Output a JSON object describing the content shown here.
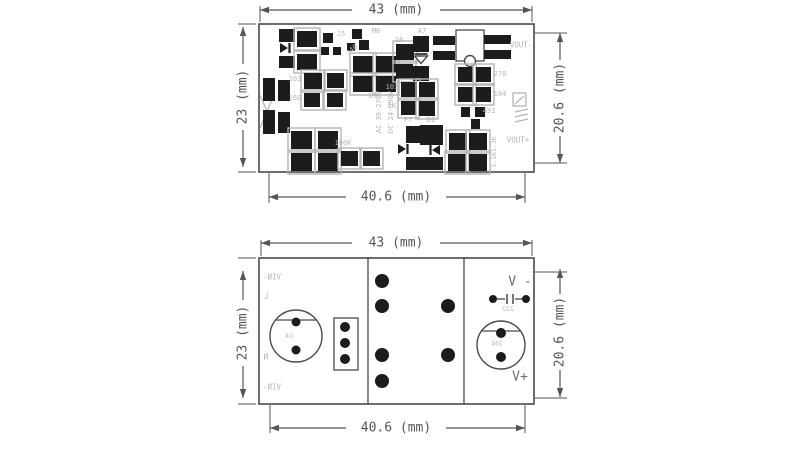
{
  "title": "pcb-power-module-dimension-drawing",
  "colors": {
    "background": "#ffffff",
    "outline": "#4a4a4a",
    "dim": "#555555",
    "pad": "#1c1c1c",
    "silk": "#b4b4b4",
    "text_dark": "#6e6e6e"
  },
  "views": [
    {
      "name": "pcb-top-view",
      "board": {
        "x": 259,
        "y": 24,
        "w": 275,
        "h": 148
      },
      "dividers": [],
      "rects": [
        [
          456,
          30,
          28,
          31,
          "outline",
          "transformer-outline"
        ],
        [
          513,
          93,
          13,
          13,
          "silk",
          "brand-logo-box"
        ]
      ],
      "circles": [
        {
          "cx": 470,
          "cy": 61,
          "r": 5.5,
          "fill": "#ffffff",
          "stroke": "outline",
          "n": "transformer-notch"
        }
      ],
      "lines": [
        [
          515,
          104,
          524,
          96,
          "silk",
          1.2,
          "brand-logo-stroke"
        ],
        [
          515,
          112,
          528,
          109,
          "silk",
          1.2,
          "brand-logo-stroke"
        ],
        [
          515,
          117,
          528,
          114,
          "silk",
          1.2,
          "brand-logo-stroke"
        ],
        [
          515,
          122,
          528,
          119,
          "silk",
          1.2,
          "brand-logo-stroke"
        ],
        [
          260,
          95,
          274,
          128,
          "silk",
          1.2,
          "component-ghost-outline"
        ],
        [
          274,
          95,
          260,
          128,
          "silk",
          1.2,
          "component-ghost-outline"
        ]
      ],
      "pads": [
        [
          279,
          29,
          16,
          13,
          0
        ],
        [
          279,
          56,
          16,
          12,
          0
        ],
        [
          297,
          31,
          20,
          16,
          1
        ],
        [
          297,
          54,
          20,
          16,
          1
        ],
        [
          323,
          33,
          10,
          10,
          0
        ],
        [
          352,
          29,
          10,
          10,
          0
        ],
        [
          321,
          47,
          8,
          8,
          0
        ],
        [
          333,
          47,
          8,
          8,
          0
        ],
        [
          347,
          43,
          8,
          8,
          0
        ],
        [
          359,
          40,
          10,
          10,
          0
        ],
        [
          353,
          56,
          20,
          17,
          1
        ],
        [
          376,
          56,
          20,
          17,
          1
        ],
        [
          353,
          76,
          20,
          16,
          1
        ],
        [
          376,
          76,
          20,
          16,
          1
        ],
        [
          304,
          73,
          18,
          16,
          1
        ],
        [
          327,
          73,
          17,
          15,
          1
        ],
        [
          304,
          93,
          16,
          14,
          1
        ],
        [
          327,
          93,
          16,
          14,
          1
        ],
        [
          263,
          78,
          12,
          23,
          0
        ],
        [
          278,
          80,
          12,
          21,
          0
        ],
        [
          263,
          110,
          12,
          24,
          0
        ],
        [
          278,
          112,
          12,
          21,
          0
        ],
        [
          291,
          131,
          21,
          18,
          1
        ],
        [
          318,
          131,
          20,
          18,
          1
        ],
        [
          291,
          153,
          21,
          18,
          1
        ],
        [
          318,
          153,
          20,
          18,
          1
        ],
        [
          341,
          151,
          17,
          15,
          1
        ],
        [
          363,
          151,
          17,
          15,
          1
        ],
        [
          396,
          44,
          18,
          16,
          1
        ],
        [
          396,
          64,
          17,
          15,
          1
        ],
        [
          413,
          36,
          16,
          16,
          0
        ],
        [
          413,
          66,
          16,
          15,
          0
        ],
        [
          401,
          82,
          16,
          15,
          1
        ],
        [
          419,
          82,
          16,
          15,
          1
        ],
        [
          401,
          101,
          15,
          14,
          1
        ],
        [
          419,
          101,
          16,
          15,
          1
        ],
        [
          406,
          126,
          18,
          17,
          0
        ],
        [
          406,
          157,
          18,
          13,
          0
        ],
        [
          420,
          125,
          23,
          20,
          0
        ],
        [
          420,
          157,
          23,
          13,
          0
        ],
        [
          433,
          36,
          22,
          9,
          0
        ],
        [
          433,
          51,
          22,
          9,
          0
        ],
        [
          484,
          35,
          27,
          9,
          0
        ],
        [
          484,
          50,
          27,
          9,
          0
        ],
        [
          458,
          67,
          15,
          15,
          1
        ],
        [
          476,
          67,
          15,
          15,
          1
        ],
        [
          458,
          87,
          15,
          15,
          1
        ],
        [
          476,
          87,
          15,
          15,
          1
        ],
        [
          461,
          107,
          9,
          10,
          0
        ],
        [
          475,
          107,
          10,
          10,
          0
        ],
        [
          471,
          119,
          9,
          10,
          0
        ],
        [
          449,
          133,
          18,
          17,
          1
        ],
        [
          469,
          133,
          18,
          17,
          1
        ],
        [
          448,
          154,
          18,
          17,
          1
        ],
        [
          469,
          154,
          18,
          17,
          1
        ]
      ],
      "holes": [],
      "symbols": [
        {
          "type": "diode-right",
          "x": 280,
          "y": 48,
          "n": "diode-symbol"
        },
        {
          "type": "diode-down-outline",
          "x": 421,
          "y": 56,
          "n": "diode-symbol-a7"
        },
        {
          "type": "diode-right",
          "x": 398,
          "y": 149,
          "n": "diode-symbol-f7"
        },
        {
          "type": "diode-left",
          "x": 440,
          "y": 150,
          "n": "diode-symbol-d2"
        }
      ],
      "dimensions": [
        {
          "n": "dim-top-width",
          "label": "43 (mm)",
          "orient": "h",
          "x1": 260,
          "x2": 532,
          "pos": 10,
          "label_at": 396,
          "gap": 44,
          "ext": [
            [
              260,
              6,
              260,
              22
            ],
            [
              532,
              6,
              532,
              22
            ]
          ]
        },
        {
          "n": "dim-left-height",
          "label": "23 (mm)",
          "orient": "v",
          "y1": 27,
          "y2": 167,
          "pos": 243,
          "label_at": 97,
          "gap": 33,
          "ext": [
            [
              238,
              24,
              256,
              24
            ],
            [
              238,
              172,
              256,
              172
            ]
          ]
        },
        {
          "n": "dim-right-height",
          "label": "20.6 (mm)",
          "orient": "v",
          "y1": 33,
          "y2": 163,
          "pos": 560,
          "label_at": 98,
          "gap": 38,
          "ext": [
            [
              535,
              33,
              567,
              33
            ],
            [
              535,
              163,
              567,
              163
            ]
          ]
        },
        {
          "n": "dim-bottom-width",
          "label": "40.6 (mm)",
          "orient": "h",
          "x1": 269,
          "x2": 525,
          "pos": 197,
          "label_at": 396,
          "gap": 50,
          "ext": [
            [
              269,
              173,
              269,
              203
            ],
            [
              525,
              173,
              525,
              203
            ]
          ]
        }
      ],
      "texts": [
        {
          "t": "J5",
          "x": 341,
          "y": 34,
          "n": "label-j5"
        },
        {
          "t": "M0",
          "x": 376,
          "y": 31,
          "n": "label-m0"
        },
        {
          "t": "340",
          "x": 352,
          "y": 50,
          "rot": -40,
          "n": "label-340"
        },
        {
          "t": "16",
          "x": 399,
          "y": 40,
          "n": "label-16"
        },
        {
          "t": "A7",
          "x": 422,
          "y": 31,
          "n": "label-a7"
        },
        {
          "t": "103",
          "x": 295,
          "y": 79,
          "n": "label-103-left"
        },
        {
          "t": "160",
          "x": 295,
          "y": 98,
          "n": "label-160"
        },
        {
          "t": "1M",
          "x": 372,
          "y": 96,
          "n": "label-1m"
        },
        {
          "t": "103",
          "x": 392,
          "y": 87,
          "n": "label-103-mid"
        },
        {
          "t": "1K",
          "x": 392,
          "y": 106,
          "n": "label-1k"
        },
        {
          "t": "F7",
          "x": 408,
          "y": 120,
          "n": "label-f7"
        },
        {
          "t": "D2",
          "x": 431,
          "y": 120,
          "n": "label-d2"
        },
        {
          "t": "100K",
          "x": 343,
          "y": 143,
          "n": "label-100k"
        },
        {
          "t": "AC 30-270V",
          "x": 379,
          "y": 112,
          "rot": -90,
          "n": "label-ac-range"
        },
        {
          "t": "DC 24-390V",
          "x": 391,
          "y": 112,
          "rot": -90,
          "n": "label-dc-range"
        },
        {
          "t": "VOUT-",
          "x": 521,
          "y": 45,
          "s": 7.5,
          "n": "label-vout-neg"
        },
        {
          "t": "270",
          "x": 500,
          "y": 74,
          "n": "label-270"
        },
        {
          "t": "104",
          "x": 500,
          "y": 94,
          "n": "label-104"
        },
        {
          "t": "431",
          "x": 489,
          "y": 111,
          "n": "label-431"
        },
        {
          "t": "5.1K1.3K",
          "x": 494,
          "y": 152,
          "rot": -90,
          "s": 6.5,
          "n": "label-5k1-1k3"
        },
        {
          "t": "VOUT+",
          "x": 518,
          "y": 140,
          "s": 7.5,
          "n": "label-vout-pos"
        }
      ]
    },
    {
      "name": "pcb-bottom-view",
      "board": {
        "x": 259,
        "y": 258,
        "w": 275,
        "h": 146
      },
      "dividers": [
        368,
        464
      ],
      "rects": [
        [
          334,
          318,
          24,
          52,
          "outline",
          "pin-connector-outline"
        ]
      ],
      "circles": [
        {
          "cx": 296,
          "cy": 336,
          "r": 26,
          "chord": 320,
          "stroke": "outline",
          "n": "electrolytic-cap-left"
        },
        {
          "cx": 501,
          "cy": 345,
          "r": 24,
          "chord": 331,
          "stroke": "outline",
          "n": "electrolytic-cap-right"
        }
      ],
      "lines": [
        [
          497,
          299,
          505,
          299,
          "dim",
          1.4,
          "cap-symbol-lead"
        ],
        [
          515,
          299,
          523,
          299,
          "dim",
          1.4,
          "cap-symbol-lead"
        ],
        [
          507,
          294,
          507,
          304,
          "dim",
          1.6,
          "cap-symbol-plate"
        ],
        [
          513,
          294,
          513,
          304,
          "dim",
          1.6,
          "cap-symbol-plate"
        ]
      ],
      "pads": [],
      "holes": [
        [
          296,
          322,
          4.5
        ],
        [
          296,
          350,
          4.5
        ],
        [
          345,
          327,
          5
        ],
        [
          345,
          343,
          5
        ],
        [
          345,
          359,
          5
        ],
        [
          382,
          281,
          7
        ],
        [
          382,
          306,
          7
        ],
        [
          382,
          355,
          7
        ],
        [
          382,
          381,
          7
        ],
        [
          448,
          306,
          7
        ],
        [
          448,
          355,
          7
        ],
        [
          493,
          299,
          4
        ],
        [
          526,
          299,
          4
        ],
        [
          501,
          333,
          5
        ],
        [
          501,
          357,
          5
        ]
      ],
      "symbols": [],
      "dimensions": [
        {
          "n": "dim-top-width",
          "label": "43 (mm)",
          "orient": "h",
          "x1": 261,
          "x2": 532,
          "pos": 243,
          "label_at": 396,
          "gap": 44,
          "ext": [
            [
              261,
              240,
              261,
              256
            ],
            [
              532,
              240,
              532,
              256
            ]
          ]
        },
        {
          "n": "dim-left-height",
          "label": "23 (mm)",
          "orient": "v",
          "y1": 271,
          "y2": 398,
          "pos": 243,
          "label_at": 333,
          "gap": 33,
          "ext": [
            [
              238,
              258,
              256,
              258
            ],
            [
              238,
              404,
              256,
              404
            ]
          ]
        },
        {
          "n": "dim-right-height",
          "label": "20.6 (mm)",
          "orient": "v",
          "y1": 269,
          "y2": 397,
          "pos": 560,
          "label_at": 332,
          "gap": 38,
          "ext": [
            [
              535,
              272,
              567,
              272
            ],
            [
              535,
              398,
              567,
              398
            ]
          ]
        },
        {
          "n": "dim-bottom-width",
          "label": "40.6 (mm)",
          "orient": "h",
          "x1": 270,
          "x2": 525,
          "pos": 428,
          "label_at": 396,
          "gap": 50,
          "ext": [
            [
              270,
              405,
              270,
              433
            ],
            [
              525,
              405,
              525,
              433
            ]
          ]
        }
      ],
      "texts": [
        {
          "t": "VIN-",
          "x": 272,
          "y": 277,
          "s": 7.5,
          "mir": 1,
          "n": "label-vin-neg-top"
        },
        {
          "t": "L",
          "x": 266,
          "y": 296,
          "s": 8,
          "mir": 1,
          "n": "label-line-l"
        },
        {
          "t": "C4",
          "x": 289,
          "y": 336,
          "s": 6.5,
          "mir": 1,
          "n": "label-c4"
        },
        {
          "t": "N",
          "x": 266,
          "y": 357,
          "s": 8,
          "mir": 1,
          "n": "label-neutral-n"
        },
        {
          "t": "VIN-",
          "x": 272,
          "y": 387,
          "s": 7.5,
          "mir": 1,
          "n": "label-vin-neg-bottom"
        },
        {
          "t": "V -",
          "x": 520,
          "y": 282,
          "s": 13,
          "c": "dark",
          "n": "label-v-neg"
        },
        {
          "t": "222",
          "x": 508,
          "y": 309,
          "s": 6.5,
          "mir": 1,
          "n": "label-222"
        },
        {
          "t": "104",
          "x": 497,
          "y": 344,
          "s": 6,
          "mir": 1,
          "n": "label-104-cap"
        },
        {
          "t": "V+",
          "x": 520,
          "y": 377,
          "s": 13,
          "c": "dark",
          "n": "label-v-pos"
        }
      ]
    }
  ]
}
